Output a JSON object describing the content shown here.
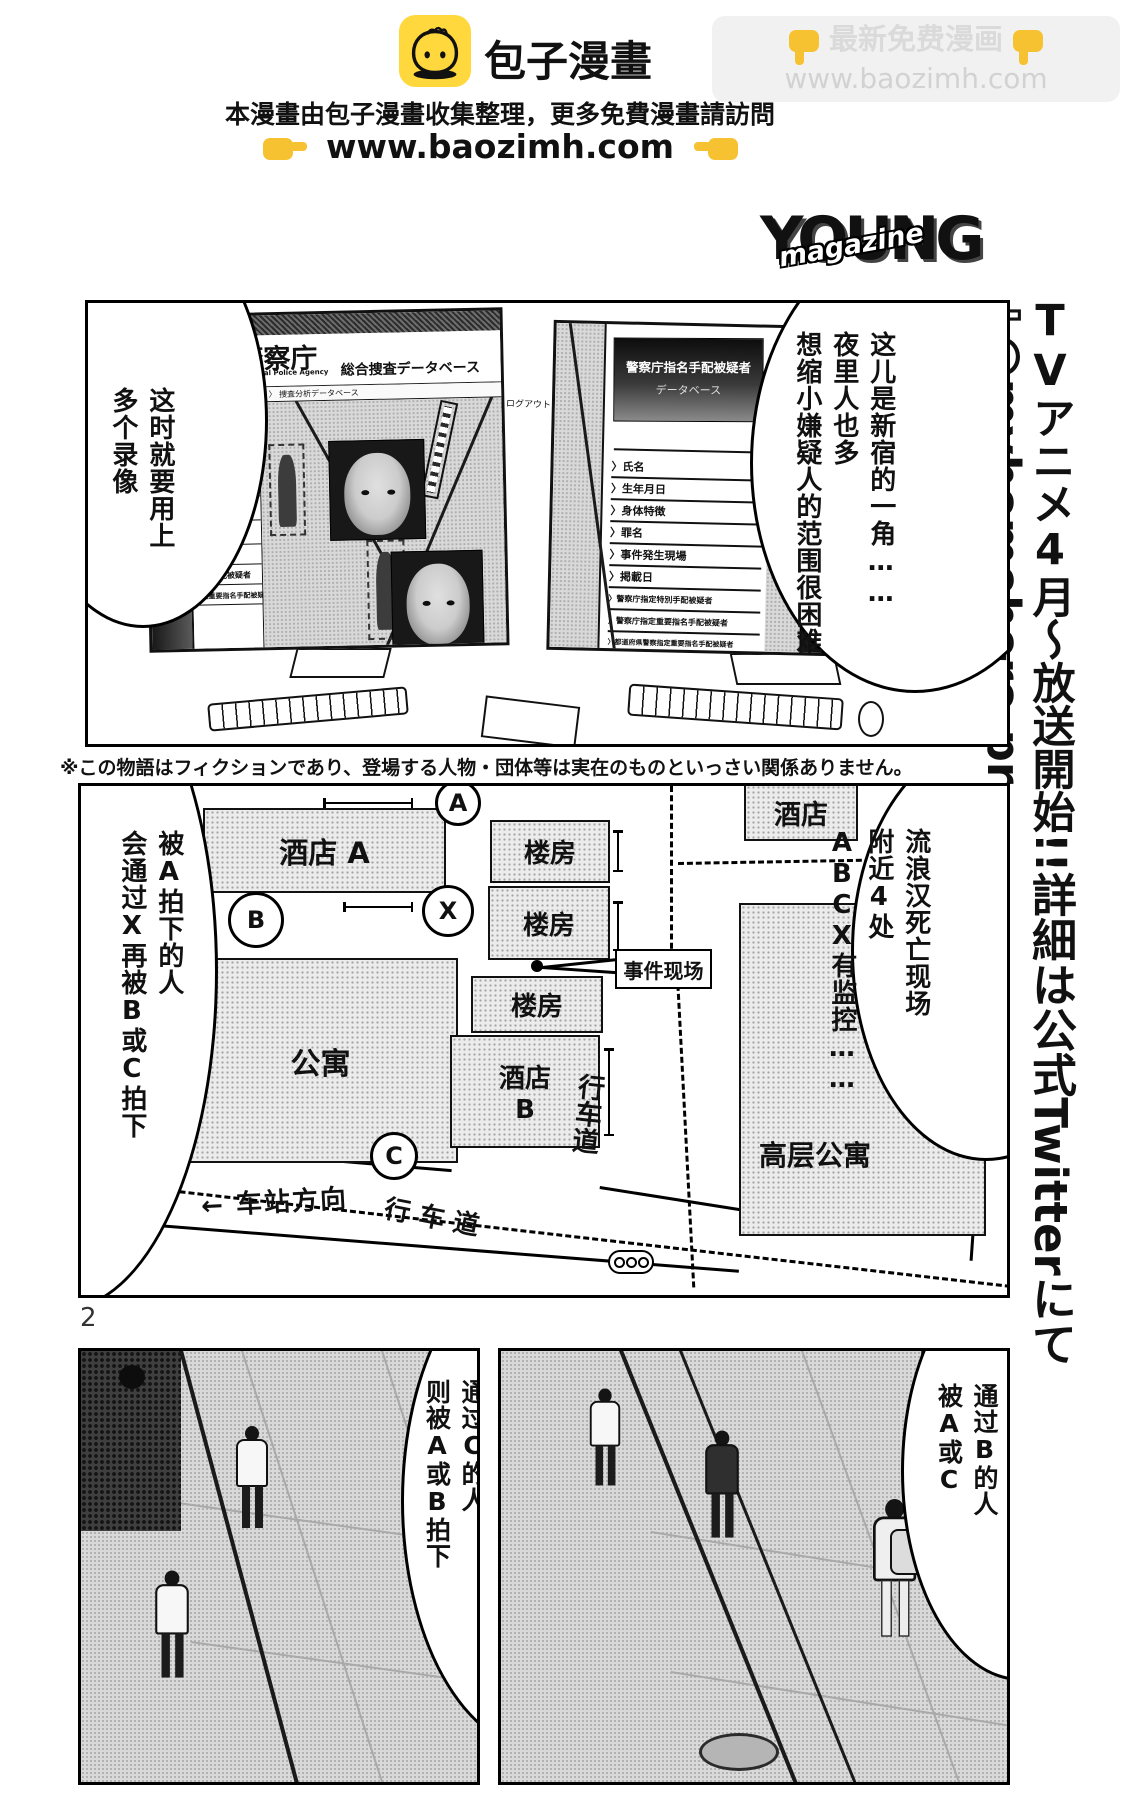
{
  "header": {
    "site_name": "包子漫畫",
    "notice": "本漫畫由包子漫畫收集整理，更多免費漫畫請訪問",
    "url_line": "www.baozimh.com",
    "promo": {
      "text": "最新免费漫画",
      "url": "www.baozimh.com"
    }
  },
  "young_logo": {
    "main": "YOUNG",
    "script": "magazine"
  },
  "side_banner": {
    "tv": "TV",
    "anime": "アニメ",
    "four": "4",
    "broadcast": "月～放送開始!!",
    "detail": "詳細は公式",
    "twitter": "Twitter",
    "nite": "にて",
    "arrow": "⇩",
    "handle": "@myhomehero-pr"
  },
  "panel1": {
    "bubble_right": {
      "col1": "这儿是新宿的一角……",
      "col2": "夜里人也多",
      "col3": "想缩小嫌疑人的范围很困难"
    },
    "bubble_left": {
      "col1": "这时就要用上",
      "col2": "多个录像"
    },
    "screen": {
      "edge_label": "被疑者",
      "agency": "警察庁",
      "agency_en": "National Police Agency",
      "db_title": "総合捜査データベース",
      "breadcrumb": "ホーム 〉 捜査項目 〉 捜査分析データベース",
      "logout": "ログアウト",
      "search_glyph": "ρ",
      "sidebar_rows": {
        "r1": "手配被疑者",
        "r2": "指名手配被疑者",
        "r3": "指定重要指名手配被疑者"
      },
      "db_sidebar_title1": "警察庁指名手配被疑者",
      "db_sidebar_title2": "データベース",
      "menu_prefix": "〉",
      "menu": [
        "氏名",
        "生年月日",
        "身体特徴",
        "罪名",
        "事件発生現場",
        "掲載日",
        "警察庁指定特別手配被疑者",
        "警察庁指定重要指名手配被疑者",
        "都道府県警察指定重要指名手配被疑者"
      ]
    }
  },
  "disclaimer": "※この物語はフィクションであり、登場する人物・団体等は実在のものといっさい関係ありません。",
  "map": {
    "bubble_left": {
      "col1": "被A拍下的人",
      "col2": "会通过X再被B或C拍下"
    },
    "bubble_right": {
      "col1": "流浪汉死亡现场",
      "col2": "附近4处",
      "col3": "ABCX有监控……"
    },
    "labels": {
      "hotel_a": "酒店 A",
      "building": "楼房",
      "hotel_b1": "酒店",
      "hotel_b2": "B",
      "apartment": "公寓",
      "hotel": "酒店",
      "highrise": "高层公寓",
      "site": "事件现场",
      "road": "行车道",
      "station": "← 车站方向"
    },
    "cameras": {
      "a": "A",
      "b": "B",
      "c": "C",
      "x": "X"
    }
  },
  "page_number": "2",
  "panel3": {
    "bubble": {
      "col1": "通过C的人",
      "col2": "则被A或B拍下"
    }
  },
  "panel4": {
    "bubble": {
      "col1": "通过B的人",
      "col2": "被A或C"
    }
  }
}
